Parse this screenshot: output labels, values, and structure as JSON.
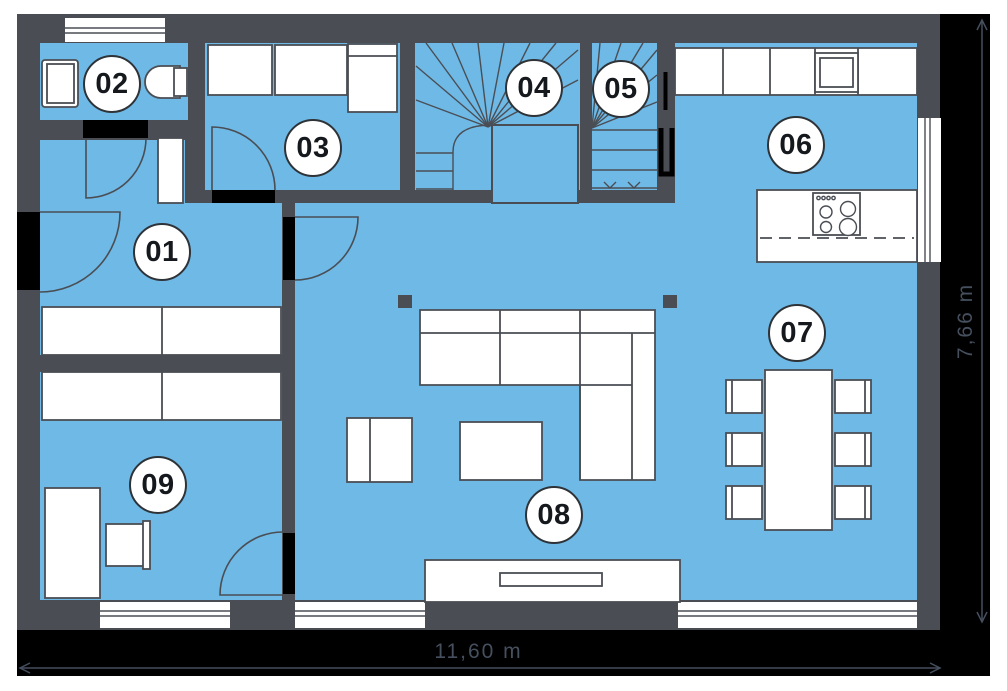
{
  "rooms": [
    {
      "id": "01"
    },
    {
      "id": "02"
    },
    {
      "id": "03"
    },
    {
      "id": "04"
    },
    {
      "id": "05"
    },
    {
      "id": "06"
    },
    {
      "id": "07"
    },
    {
      "id": "08"
    },
    {
      "id": "09"
    }
  ],
  "dimensions": {
    "width": "11,60 m",
    "height": "7,66 m"
  },
  "colors": {
    "floor": "#6FB9E6",
    "wall": "#4A4E54",
    "door_opening": "#000000",
    "furniture_fill": "#FFFFFF",
    "dimension_band": "#000000",
    "dimension_text": "#454F5E",
    "badge_text": "#15181C"
  }
}
